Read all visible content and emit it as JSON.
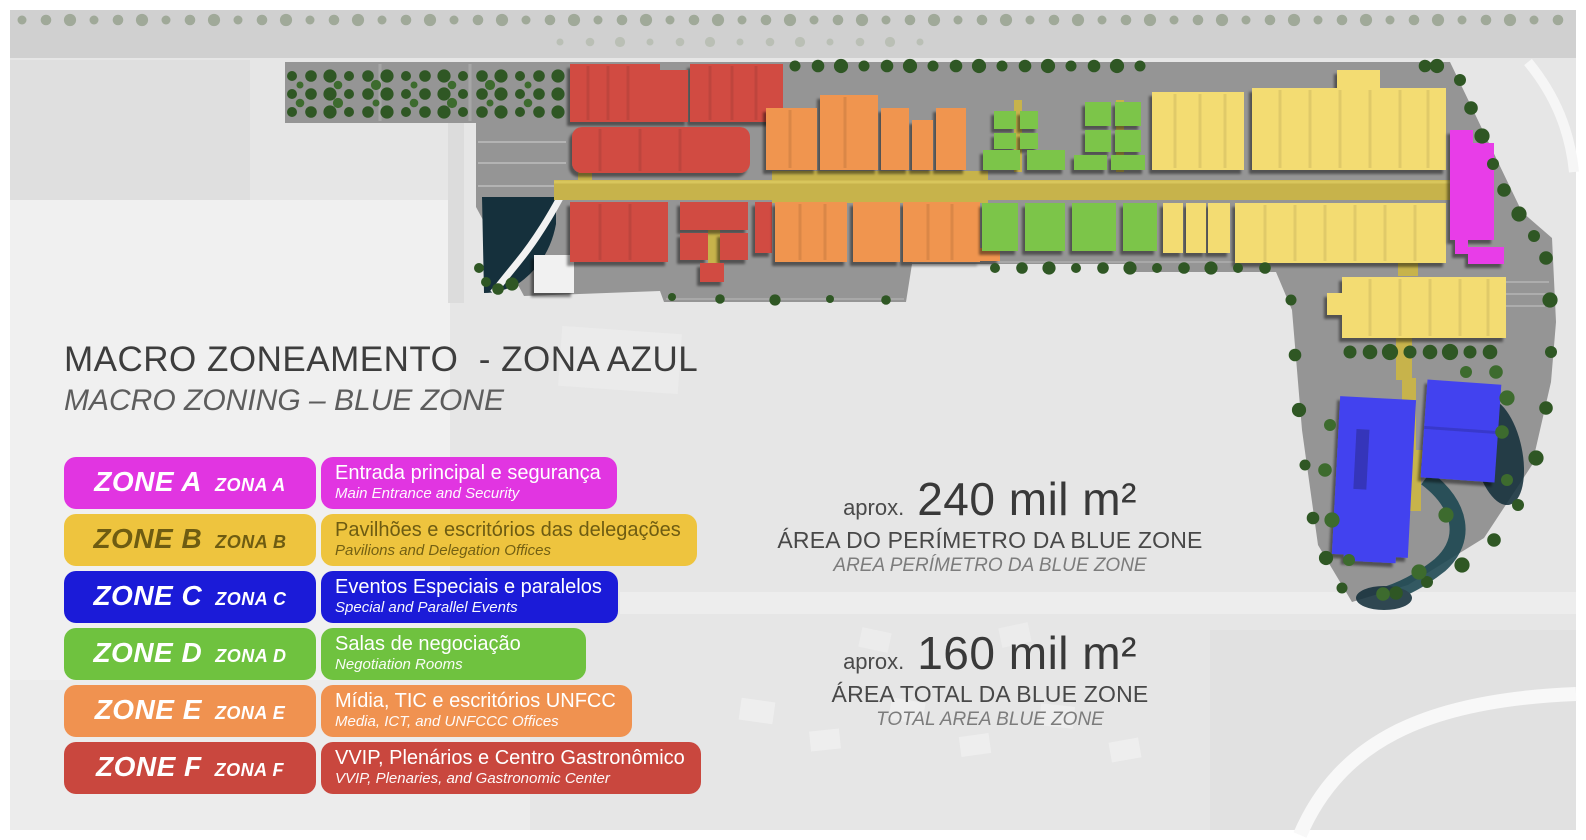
{
  "title": {
    "line1": "MACRO ZONEAMENTO  - ZONA AZUL",
    "line2": "MACRO ZONING – BLUE ZONE"
  },
  "legend": {
    "rows": [
      {
        "zone": "ZONE A",
        "zona": "ZONA A",
        "desc": "Entrada principal e segurança",
        "desc_en": "Main Entrance and Security",
        "color": "#e135e1",
        "text_color": "#ffffff"
      },
      {
        "zone": "ZONE B",
        "zona": "ZONA B",
        "desc": "Pavilhões e escritórios das delegações",
        "desc_en": "Pavilions and Delegation Offices",
        "color": "#eec43e",
        "text_color": "#6e5c12"
      },
      {
        "zone": "ZONE C",
        "zona": "ZONA C",
        "desc": "Eventos Especiais e paralelos",
        "desc_en": "Special and Parallel Events",
        "color": "#1b1bd8",
        "text_color": "#ffffff"
      },
      {
        "zone": "ZONE D",
        "zona": "ZONA D",
        "desc": "Salas de negociação",
        "desc_en": "Negotiation Rooms",
        "color": "#6fc23f",
        "text_color": "#ffffff"
      },
      {
        "zone": "ZONE E",
        "zona": "ZONA E",
        "desc": "Mídia, TIC e escritórios UNFCC",
        "desc_en": "Media, ICT, and UNFCCC Offices",
        "color": "#f09250",
        "text_color": "#ffffff"
      },
      {
        "zone": "ZONE F",
        "zona": "ZONA F",
        "desc": "VVIP, Plenários e Centro Gastronômico",
        "desc_en": "VVIP, Plenaries, and Gastronomic Center",
        "color": "#c9473e",
        "text_color": "#ffffff"
      }
    ]
  },
  "stats": [
    {
      "prefix": "aprox.",
      "value": "240 mil m²",
      "label": "ÁREA DO PERÍMETRO DA BLUE ZONE",
      "label_en": "AREA PERÍMETRO DA BLUE ZONE"
    },
    {
      "prefix": "aprox.",
      "value": "160 mil m²",
      "label": "ÁREA TOTAL DA BLUE ZONE",
      "label_en": "TOTAL AREA BLUE ZONE"
    }
  ],
  "map": {
    "colors": {
      "zone_a": "#e83ce8",
      "zone_b": "#f3dc72",
      "zone_c": "#4343ef",
      "zone_d": "#7cc548",
      "zone_e": "#f0954f",
      "zone_f": "#d14b42",
      "road": "#c7b34b",
      "site": "#959595",
      "water": "#15303c",
      "trees": "#2f5724"
    }
  }
}
